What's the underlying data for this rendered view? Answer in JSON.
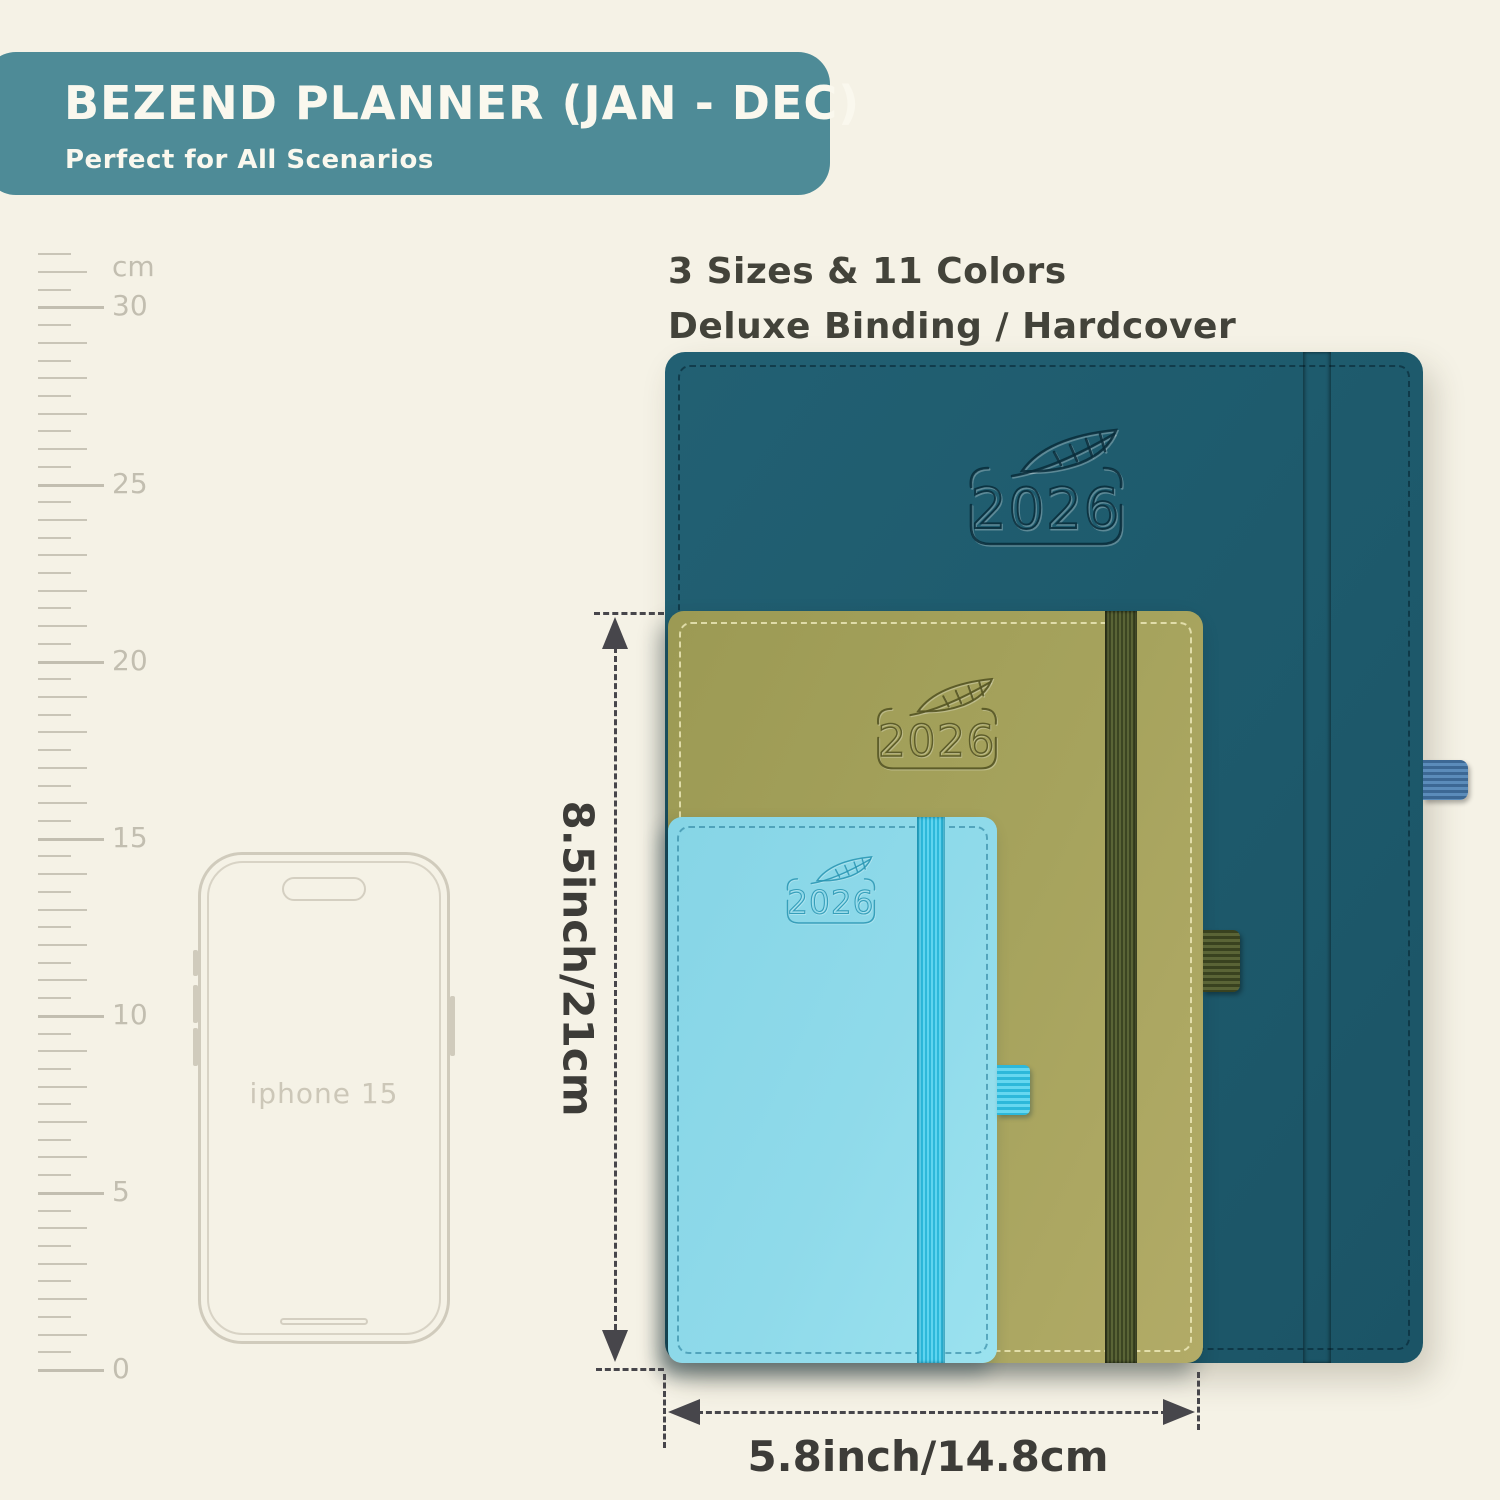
{
  "banner": {
    "title": "BEZEND PLANNER (JAN - DEC)",
    "subtitle": "Perfect for All Scenarios",
    "bg_color": "#4e8b97",
    "text_color": "#faf8ee"
  },
  "headline": {
    "line1": "3 Sizes & 11 Colors",
    "line2": "Deluxe Binding / Hardcover"
  },
  "ruler": {
    "unit_label": "cm",
    "tick_labels": [
      {
        "text": "cm",
        "cm": 31.1
      },
      {
        "text": "30",
        "cm": 30
      },
      {
        "text": "25",
        "cm": 25
      },
      {
        "text": "20",
        "cm": 20
      },
      {
        "text": "15",
        "cm": 15
      },
      {
        "text": "10",
        "cm": 10
      },
      {
        "text": "5",
        "cm": 5
      },
      {
        "text": "0",
        "cm": 0
      }
    ]
  },
  "phone": {
    "label": "iphone 15"
  },
  "planners": [
    {
      "id": "large",
      "year": "2026",
      "cover_color": "#1e5b6d",
      "band_color": "#4a7aa8",
      "description": "largest teal hardcover planner with steel-blue elastic band and pen loop"
    },
    {
      "id": "medium",
      "year": "2026",
      "cover_color": "#a6a35d",
      "band_color": "#4b552e",
      "description": "medium olive-green hardcover planner with dark-olive elastic band and pen loop"
    },
    {
      "id": "small",
      "year": "2026",
      "cover_color": "#8fdaea",
      "band_color": "#3fc8e8",
      "description": "small sky-blue hardcover planner with cyan elastic band and pen loop"
    }
  ],
  "dimensions": {
    "height_label": "8.5inch/21cm",
    "width_label": "5.8inch/14.8cm"
  },
  "colors": {
    "background": "#f5f2e6",
    "annotation": "#47464b",
    "ruler": "#c2beb0"
  }
}
